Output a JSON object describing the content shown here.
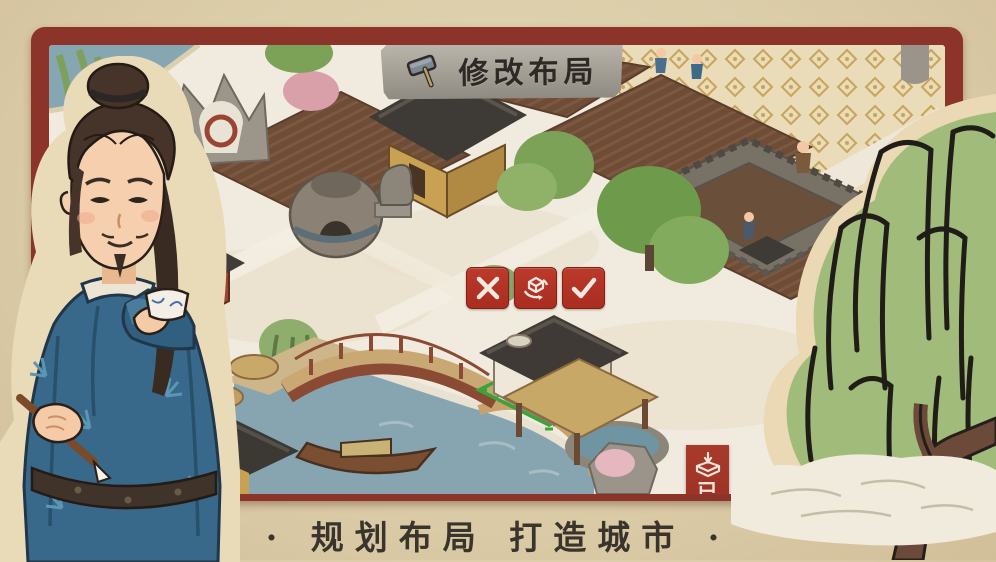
{
  "banner": {
    "icon": "hammer-icon",
    "label": "修改布局"
  },
  "edit_toolbar": {
    "cancel_icon": "close-icon",
    "rotate_icon": "rotate-building-icon",
    "confirm_icon": "confirm-check-icon"
  },
  "storage_badge": {
    "icon": "stored-buildings-box-icon",
    "label": "已"
  },
  "caption": {
    "text": "· 规划布局  打造城市 ·"
  },
  "colors": {
    "paper": "#dccda9",
    "frame_red": "#8c332a",
    "button_red": "#b23325",
    "badge_red": "#a83a2b",
    "banner_gray": "#a8a399",
    "ink_text": "#3a342c",
    "placement_grid_green": "#3aa33a",
    "water_blue": "#87a5b0"
  },
  "scene": {
    "placement_building": "white house on green placement grid",
    "landmarks": "farm fields, kiln, stone lion, arched bridge, canopy boat, city wall, patterned plaza, willow trees"
  },
  "illustrations": {
    "character": "man in blue bamboo-patterned robe holding porcelain cup and brush",
    "willow": "ink-brush willow tree over white cloud"
  }
}
